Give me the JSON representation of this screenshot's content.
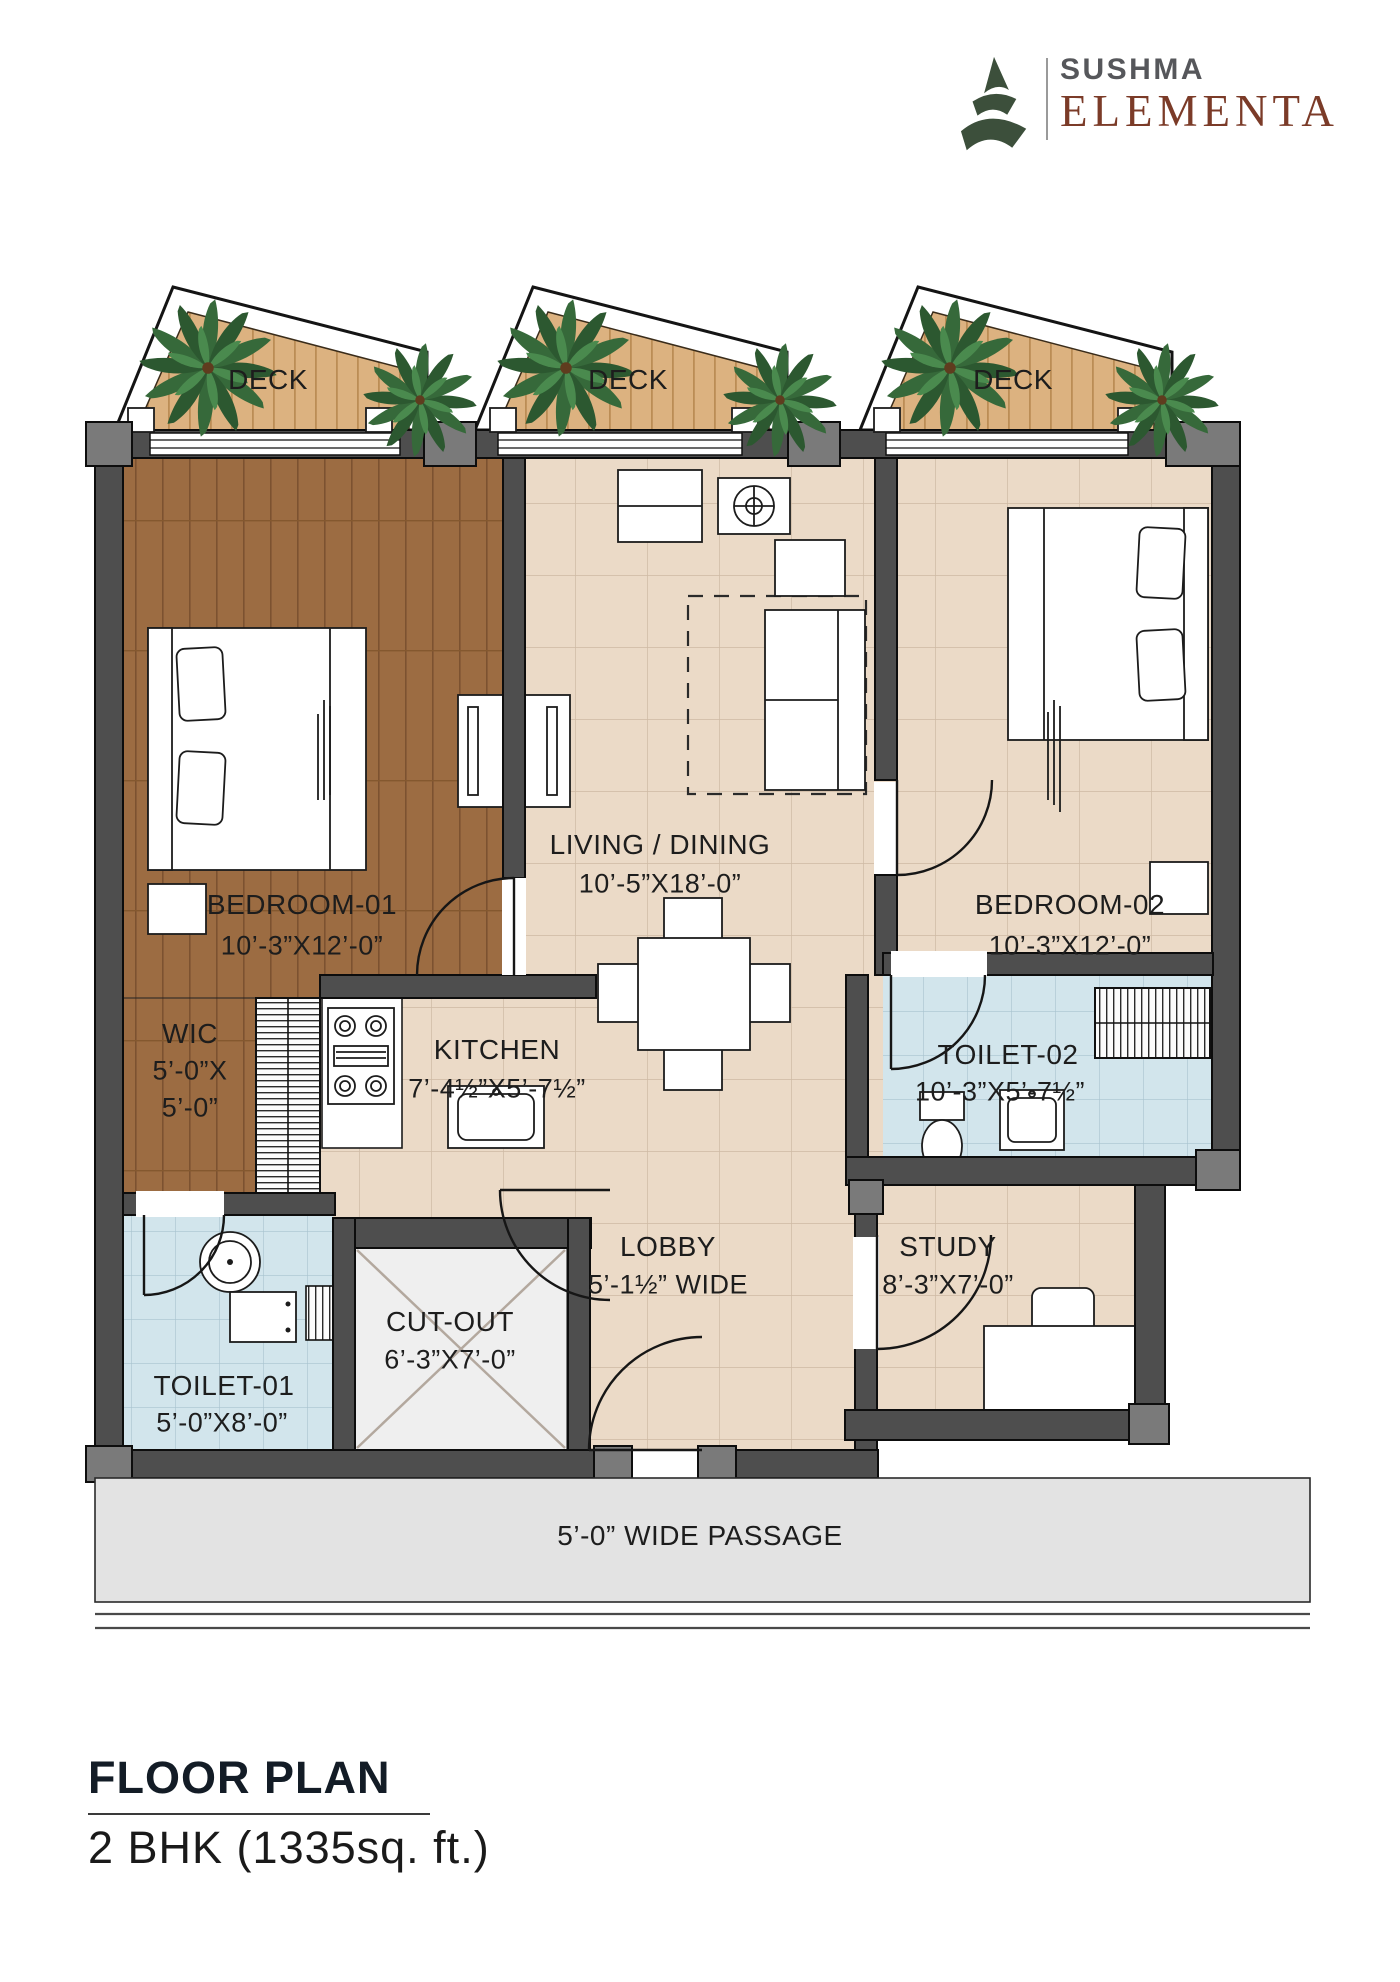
{
  "logo": {
    "brand": "SUSHMA",
    "name": "ELEMENTA"
  },
  "decks": [
    {
      "label": "DECK"
    },
    {
      "label": "DECK"
    },
    {
      "label": "DECK"
    }
  ],
  "rooms": {
    "bedroom1": {
      "name": "BEDROOM-01",
      "dims": "10’-3”X12’-0”"
    },
    "living": {
      "name": "LIVING / DINING",
      "dims": "10’-5”X18’-0”"
    },
    "bedroom2": {
      "name": "BEDROOM-02",
      "dims": "10’-3”X12’-0”"
    },
    "wic": {
      "name": "WIC",
      "dims_line1": "5’-0”X",
      "dims_line2": "5’-0”"
    },
    "kitchen": {
      "name": "KITCHEN",
      "dims": "7’-4½”X5’-7½”"
    },
    "toilet2": {
      "name": "TOILET-02",
      "dims": "10’-3”X5’-7½”"
    },
    "toilet1": {
      "name": "TOILET-01",
      "dims": "5’-0”X8’-0”"
    },
    "cutout": {
      "name": "CUT-OUT",
      "dims": "6’-3”X7’-0”"
    },
    "lobby": {
      "name": "LOBBY",
      "dims": "5’-1½” WIDE"
    },
    "study": {
      "name": "STUDY",
      "dims": "8’-3”X7’-0”"
    }
  },
  "passage": {
    "label": "5’-0” WIDE PASSAGE"
  },
  "footer": {
    "title": "FLOOR PLAN",
    "subtitle": "2 BHK (1335sq. ft.)"
  },
  "colors": {
    "wall_gray": "#4e4e4e",
    "wood_floor": "#9c6c42",
    "tile_beige": "#ebdac7",
    "toilet_blue": "#d2e5ec",
    "deck_wood": "#dcb280",
    "passage_gray": "#e3e3e3",
    "logo_green": "#3c4f3b",
    "logo_brown": "#7b3b28",
    "brand_gray": "#56575b"
  }
}
